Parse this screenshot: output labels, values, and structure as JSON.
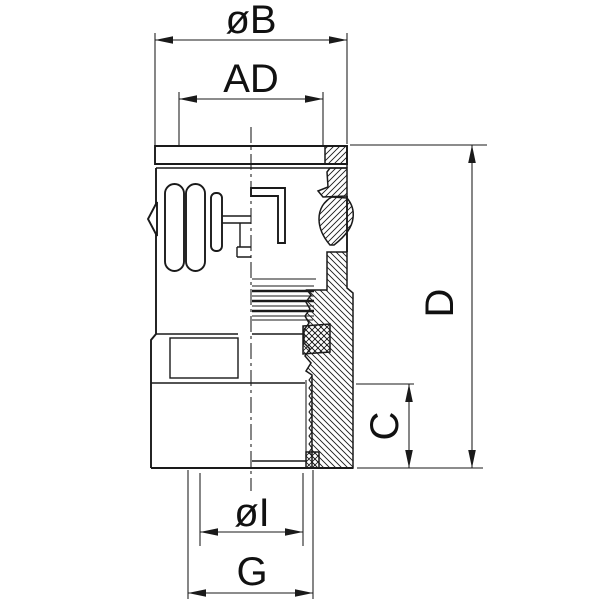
{
  "drawing": {
    "labels": {
      "dia_b": "øB",
      "ad": "AD",
      "d": "D",
      "c": "C",
      "dia_i": "øI",
      "g": "G"
    },
    "colors": {
      "line": "#1a1a1a",
      "background": "#ffffff"
    }
  }
}
